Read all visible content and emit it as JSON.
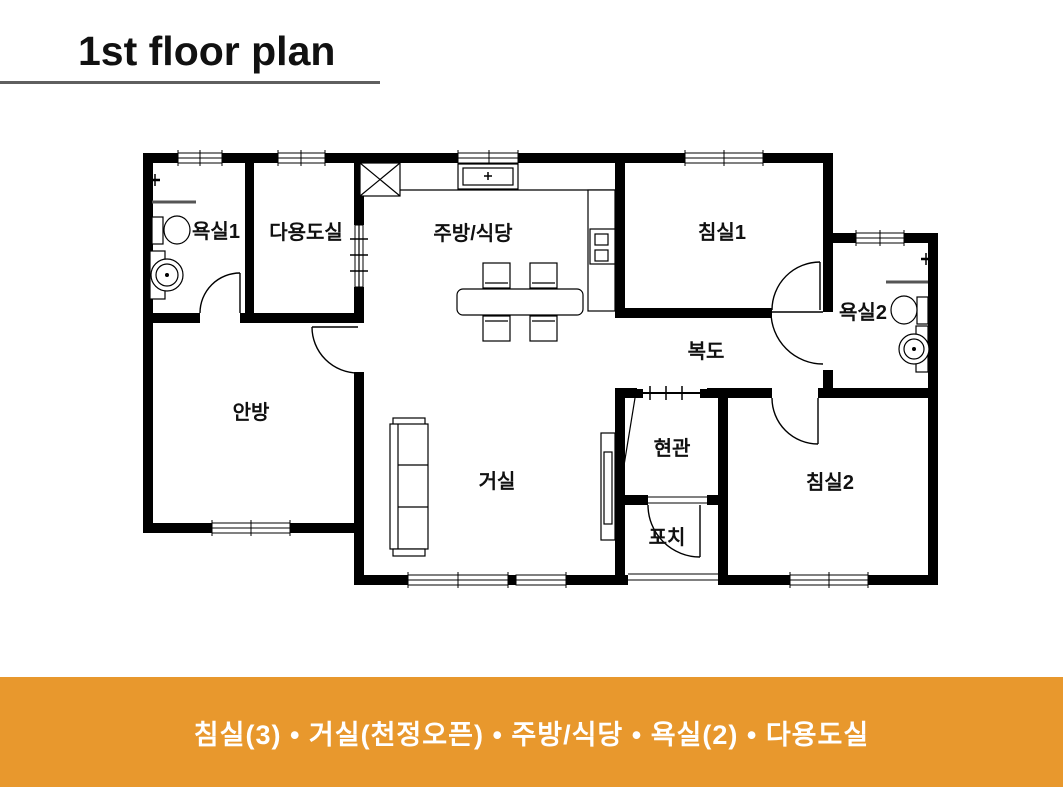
{
  "title": "1st floor plan",
  "rooms": {
    "bath1": "욕실1",
    "utility": "다용도실",
    "kitchen": "주방/식당",
    "bedroom1": "침실1",
    "bath2": "욕실2",
    "master": "안방",
    "living": "거실",
    "hallway": "복도",
    "entrance": "현관",
    "porch": "포치",
    "bedroom2": "침실2"
  },
  "banner": {
    "text": "침실(3) • 거실(천정오픈) • 주방/식당 • 욕실(2) • 다용도실",
    "background": "#E8982D",
    "text_color": "#FFFFFF"
  },
  "colors": {
    "wall": "#000000",
    "underline": "#5F5F5F"
  }
}
